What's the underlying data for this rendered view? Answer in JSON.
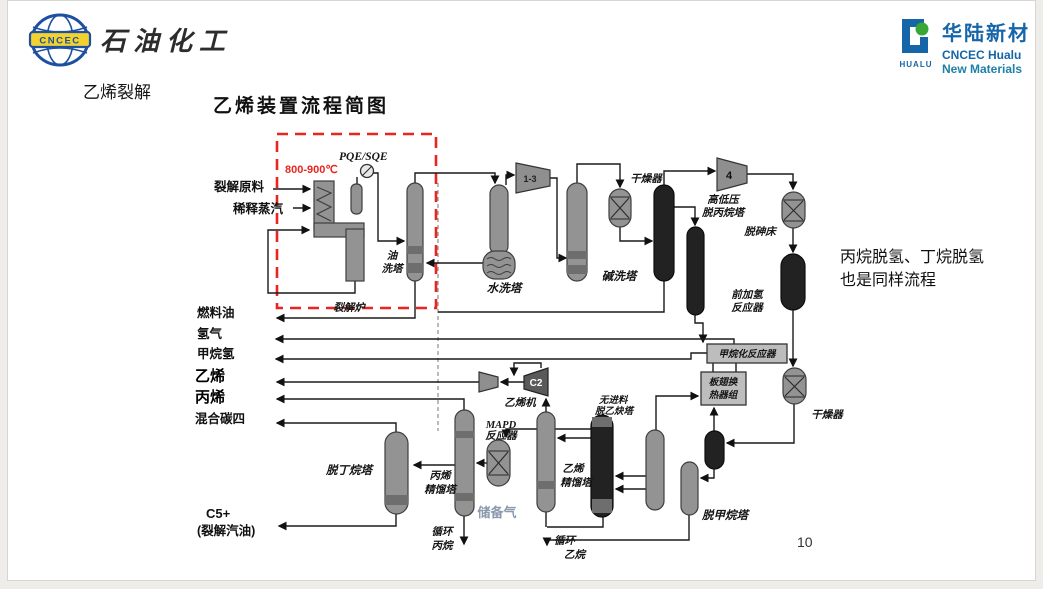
{
  "header": {
    "logo_left_text": "CNCEC",
    "brand_left": "石油化工",
    "logo_right": {
      "mark_text": "HUALU",
      "name_cn": "华陆新材",
      "name_en_line1": "CNCEC Hualu",
      "name_en_line2": "New Materials"
    }
  },
  "slide": {
    "section_label": "乙烯裂解",
    "title": "乙烯装置流程简图",
    "note_line1": "丙烷脱氢、丁烷脱氢",
    "note_line2": "也是同样流程",
    "page_number": "10"
  },
  "diagram": {
    "annotations": {
      "temperature": "800-900℃",
      "quench_exchanger": "PQE/SQE",
      "reserve_gas": "储备气"
    },
    "streams": {
      "feed": "裂解原料",
      "dilution_steam": "稀释蒸汽",
      "fuel_oil": "燃料油",
      "hydrogen": "氢气",
      "methane_h2": "甲烷氢",
      "ethylene": "乙烯",
      "propylene": "丙烯",
      "mixed_c4": "混合碳四",
      "c5": "C5+",
      "c5_sub": "(裂解汽油)",
      "recycle_propane_1": "循环",
      "recycle_propane_2": "丙烷",
      "recycle_ethane_1": "循环",
      "recycle_ethane_2": "乙烷"
    },
    "equipment": {
      "furnace": "裂解炉",
      "oil_wash_1": "油",
      "oil_wash_2": "洗塔",
      "water_wash": "水洗塔",
      "caustic_wash": "碱洗塔",
      "dryer1": "干燥器",
      "depropanizer_1": "高低压",
      "depropanizer_2": "脱丙烷塔",
      "arsenic_bed": "脱砷床",
      "front_hydro_1": "前加氢",
      "front_hydro_2": "反应器",
      "methanation": "甲烷化反应器",
      "coldbox_1": "板翅换",
      "coldbox_2": "热器组",
      "dryer2": "干燥器",
      "demethanizer": "脱甲烷塔",
      "deacetylenizer_1": "无进料",
      "deacetylenizer_2": "脱乙炔塔",
      "c2_splitter_1": "乙烯",
      "c2_splitter_2": "精馏塔",
      "mapd_1": "MAPD",
      "mapd_2": "反应器",
      "c3_splitter_1": "丙烯",
      "c3_splitter_2": "精馏塔",
      "debutanizer": "脱丁烷塔",
      "ethylene_compressor": "乙烯机",
      "compressor_main": "1-3",
      "compressor_4": "4",
      "compressor_c2": "C2"
    },
    "colors": {
      "dashed_box": "#e8251f",
      "temperature_text": "#e8251f",
      "reserve_gas_text": "#8a99ac"
    }
  }
}
